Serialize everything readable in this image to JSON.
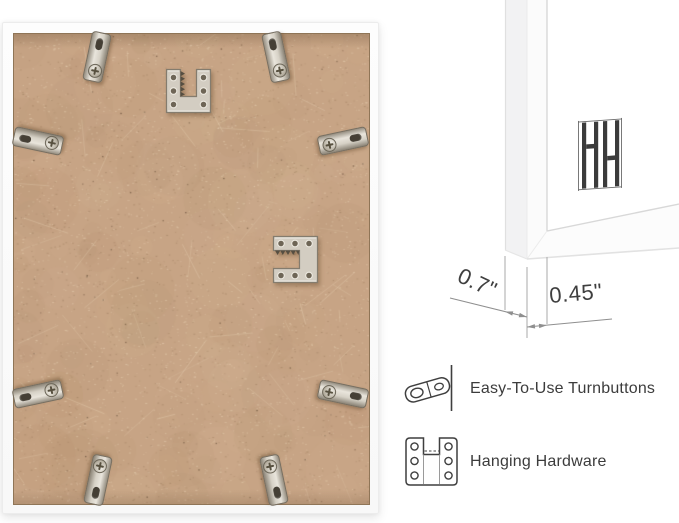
{
  "product_view": {
    "name": "picture-frame-back-view",
    "frame_color": "#fcfcfc",
    "backing_color": "#c7a485",
    "turnbutton_count": 8,
    "turnbuttons": [
      {
        "x": 93,
        "y": 33,
        "rot": 12
      },
      {
        "x": 272,
        "y": 33,
        "rot": -12
      },
      {
        "x": 34,
        "y": 117,
        "rot": -78
      },
      {
        "x": 34,
        "y": 370,
        "rot": -102
      },
      {
        "x": 339,
        "y": 117,
        "rot": 78
      },
      {
        "x": 339,
        "y": 370,
        "rot": 102
      },
      {
        "x": 94,
        "y": 456,
        "rot": 192
      },
      {
        "x": 270,
        "y": 456,
        "rot": 168
      }
    ],
    "hanging_plates": [
      {
        "x": 162,
        "y": 45,
        "variant": "notch-up"
      },
      {
        "x": 269,
        "y": 212,
        "variant": "notch-left"
      }
    ]
  },
  "corner_detail": {
    "logo": "hh-bars-logo",
    "dimensions": [
      {
        "id": "frame-depth",
        "label": "0.7\""
      },
      {
        "id": "frame-face-width",
        "label": "0.45\""
      }
    ]
  },
  "legend": {
    "items": [
      {
        "icon": "turnbutton-icon",
        "label": "Easy-To-Use Turnbuttons"
      },
      {
        "icon": "hanging-hardware-icon",
        "label": "Hanging Hardware"
      }
    ]
  },
  "colors": {
    "background": "#ffffff",
    "metal": "#d3cdc2",
    "metal_edge": "#847c6e",
    "text": "#3c3c3c",
    "dimension_line": "#8f8f8f",
    "logo": "#3b3b3b"
  }
}
